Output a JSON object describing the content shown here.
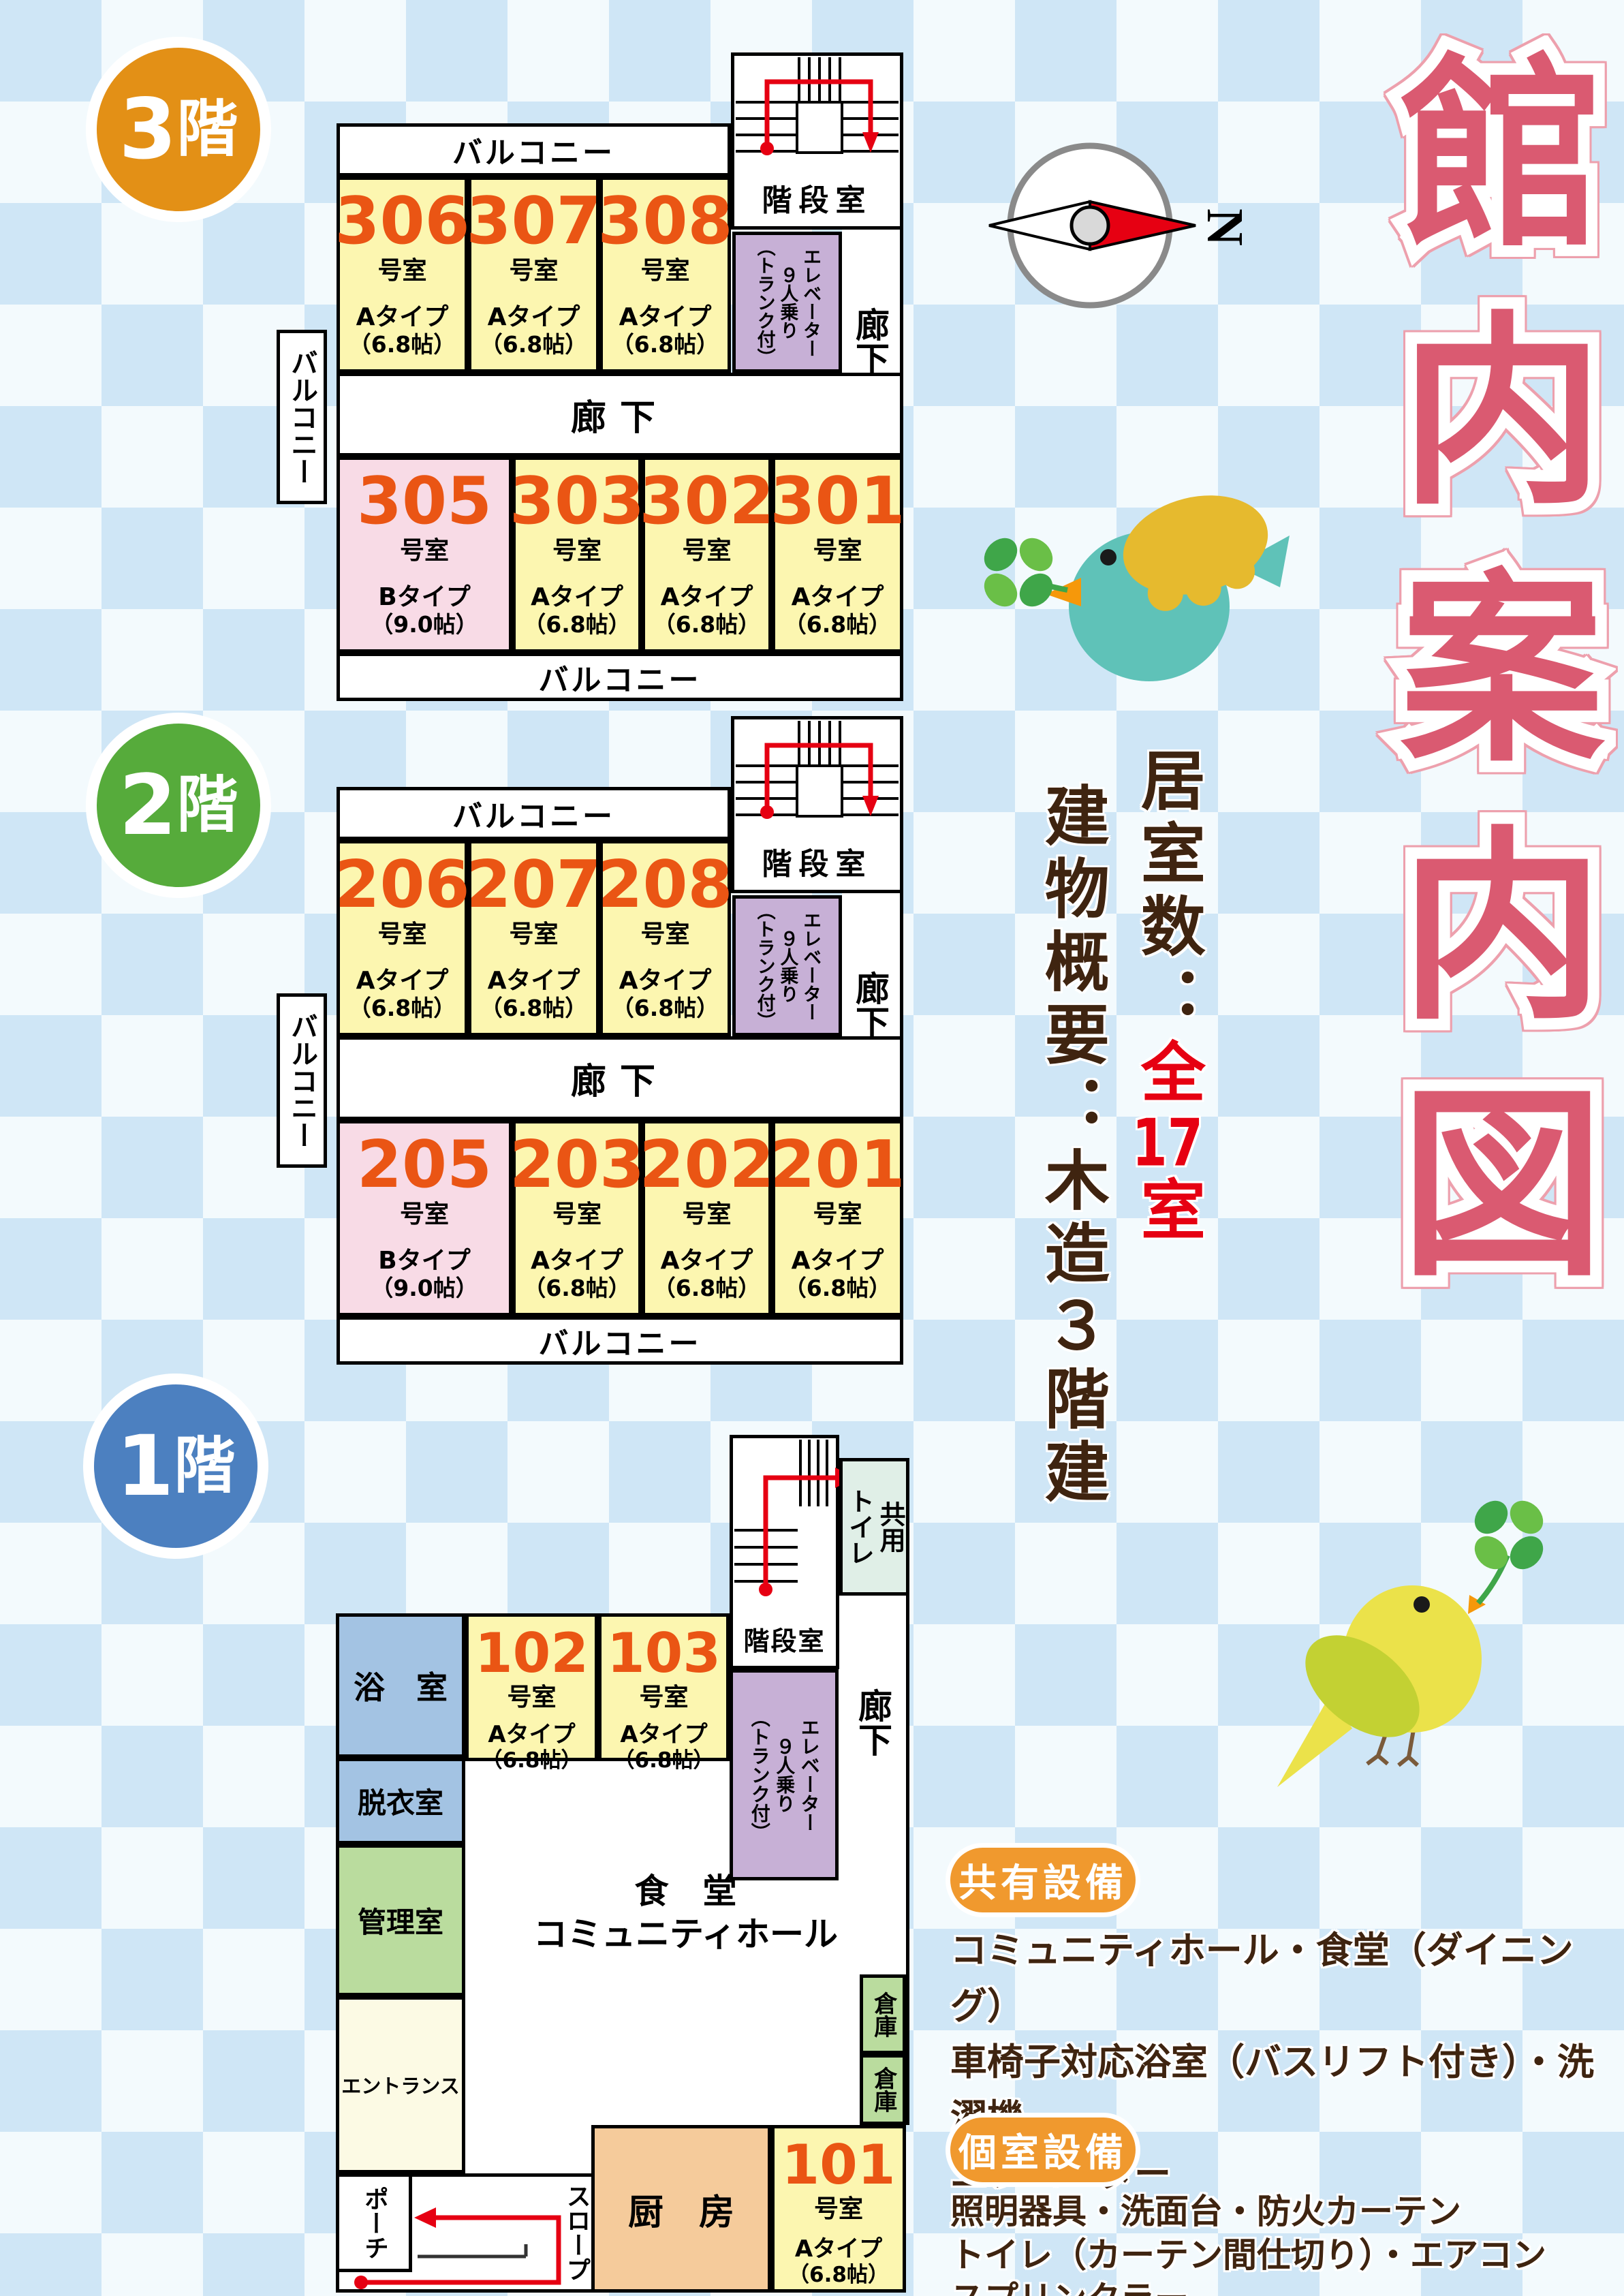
{
  "title": "館内案内図",
  "compass": {
    "north": "N"
  },
  "overview": {
    "rooms_label": "居室数：",
    "rooms_value_head": "全",
    "rooms_value_num": "17",
    "rooms_value_tail": "室",
    "building": "建物概要：木造３階建"
  },
  "labels": {
    "balcony": "バルコニー",
    "corridor": "廊下",
    "stairwell": "階段室",
    "elevator_l1": "エレベーター",
    "elevator_l2": "９人乗り",
    "elevator_l3": "（トランク付）",
    "room_suffix": "号室"
  },
  "floors": {
    "f3": {
      "badge_num": "3",
      "badge_kanji": "階",
      "rooms_top": [
        {
          "num": "306",
          "type": "Aタイプ",
          "size": "（6.8帖）"
        },
        {
          "num": "307",
          "type": "Aタイプ",
          "size": "（6.8帖）"
        },
        {
          "num": "308",
          "type": "Aタイプ",
          "size": "（6.8帖）"
        }
      ],
      "rooms_bottom": [
        {
          "num": "305",
          "type": "Bタイプ",
          "size": "（9.0帖）"
        },
        {
          "num": "303",
          "type": "Aタイプ",
          "size": "（6.8帖）"
        },
        {
          "num": "302",
          "type": "Aタイプ",
          "size": "（6.8帖）"
        },
        {
          "num": "301",
          "type": "Aタイプ",
          "size": "（6.8帖）"
        }
      ]
    },
    "f2": {
      "badge_num": "2",
      "badge_kanji": "階",
      "rooms_top": [
        {
          "num": "206",
          "type": "Aタイプ",
          "size": "（6.8帖）"
        },
        {
          "num": "207",
          "type": "Aタイプ",
          "size": "（6.8帖）"
        },
        {
          "num": "208",
          "type": "Aタイプ",
          "size": "（6.8帖）"
        }
      ],
      "rooms_bottom": [
        {
          "num": "205",
          "type": "Bタイプ",
          "size": "（9.0帖）"
        },
        {
          "num": "203",
          "type": "Aタイプ",
          "size": "（6.8帖）"
        },
        {
          "num": "202",
          "type": "Aタイプ",
          "size": "（6.8帖）"
        },
        {
          "num": "201",
          "type": "Aタイプ",
          "size": "（6.8帖）"
        }
      ]
    },
    "f1": {
      "badge_num": "1",
      "badge_kanji": "階",
      "rooms_top": [
        {
          "num": "102",
          "type": "Aタイプ",
          "size": "（6.8帖）"
        },
        {
          "num": "103",
          "type": "Aタイプ",
          "size": "（6.8帖）"
        }
      ],
      "room_101": {
        "num": "101",
        "type": "Aタイプ",
        "size": "（6.8帖）"
      },
      "bath": "浴　室",
      "dressing": "脱衣室",
      "office": "管理室",
      "entrance": "エントランス",
      "porch": "ポーチ",
      "slope": "スロープ",
      "kitchen": "厨　房",
      "storage1": "倉庫",
      "storage2": "倉庫",
      "dining_l1": "食　堂",
      "dining_l2": "コミュニティホール",
      "toilet_col1": "共用",
      "toilet_col2": "トイレ"
    }
  },
  "facilities": {
    "shared": {
      "title": "共有設備",
      "lines": [
        "コミュニティホール・食堂（ダイニング）",
        "車椅子対応浴室（バスリフト付き）・洗濯機",
        "エレベーター"
      ]
    },
    "private": {
      "title": "個室設備",
      "lines": [
        "照明器具・洗面台・防火カーテン",
        "トイレ（カーテン間仕切り）・エアコン",
        "スプリンクラー"
      ]
    }
  }
}
